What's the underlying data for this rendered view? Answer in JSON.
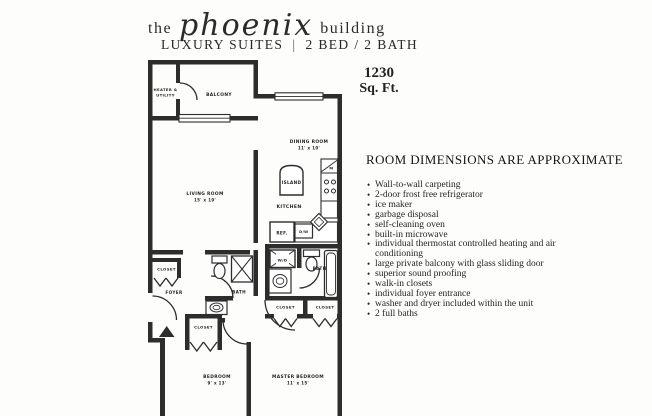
{
  "header": {
    "title_pre": "the",
    "title_script": "phoenix",
    "title_post": "building",
    "subtitle_left": "LUXURY SUITES",
    "subtitle_sep": "|",
    "subtitle_right": "2 BED / 2 BATH"
  },
  "area": {
    "value": "1230",
    "unit": "Sq. Ft."
  },
  "features": {
    "heading": "ROOM DIMENSIONS ARE APPROXIMATE",
    "items": [
      "Wall-to-wall carpeting",
      "2-door frost free refrigerator",
      "ice maker",
      "garbage disposal",
      "self-cleaning oven",
      "built-in microwave",
      "individual thermostat controlled heating and air conditioning",
      "large private balcony with glass sliding door",
      "superior sound proofing",
      "walk-in closets",
      "individual foyer entrance",
      "washer and dryer included within the unit",
      "2 full baths"
    ]
  },
  "floorplan": {
    "heater_line1": "HEATER &",
    "heater_line2": "UTILITY",
    "balcony": "BALCONY",
    "dining_name": "DINING ROOM",
    "dining_dims": "11' x 10'",
    "living_name": "LIVING ROOM",
    "living_dims": "15' x 19'",
    "island": "ISLAND",
    "kitchen": "KITCHEN",
    "ref": "REF.",
    "dw": "D/W",
    "microwave": "M",
    "wd": "W/D",
    "bath_master": "BATH",
    "bath_second": "BATH",
    "foyer": "FOYER",
    "closet_foyer": "CLOSET",
    "closet_hall": "CLOSET",
    "closet_master_left": "CLOSET",
    "closet_master_right": "CLOSET",
    "bedroom_name": "BEDROOM",
    "bedroom_dims": "9' x 13'",
    "master_name": "MASTER BEDROOM",
    "master_dims": "11' x 15'"
  },
  "colors": {
    "wall": "#2d2d2d",
    "paper": "#fdfdfc",
    "text": "#1e1e1e"
  }
}
